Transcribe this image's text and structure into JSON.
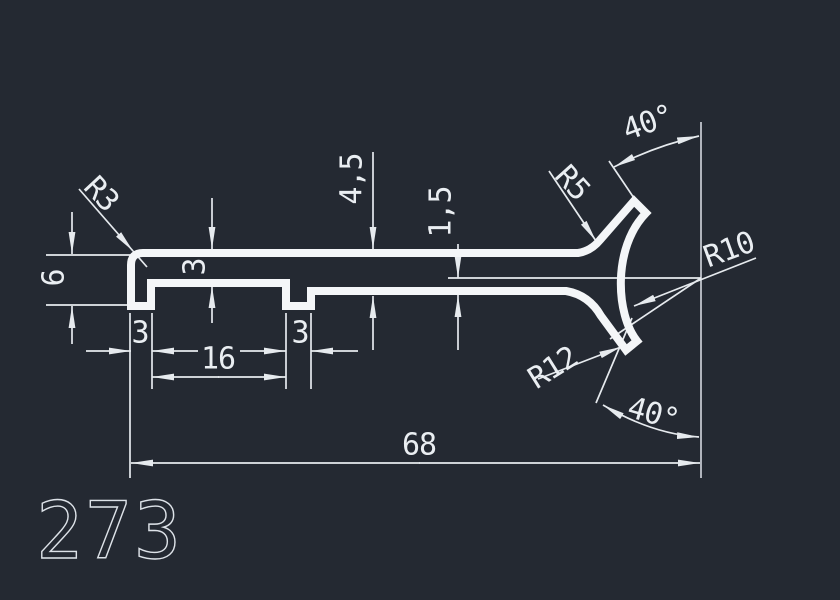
{
  "drawing_number": "273",
  "dimensions": {
    "corner_radius": "R3",
    "end_height": "6",
    "top_thickness": "3",
    "web_depth": "4,5",
    "web_thickness": "1,5",
    "upper_fillet_radius": "R5",
    "upper_arm_angle": "40°",
    "inner_arc_radius": "R10",
    "lower_fillet_radius": "R12",
    "lower_arm_angle": "40°",
    "foot_width": "3",
    "groove_width": "16",
    "notch_width": "3",
    "overall_length": "68"
  },
  "colors": {
    "background": "#242932",
    "profile_line": "#f4f6f8",
    "dimension_line": "#e6eaee",
    "text": "#eaeef2"
  }
}
